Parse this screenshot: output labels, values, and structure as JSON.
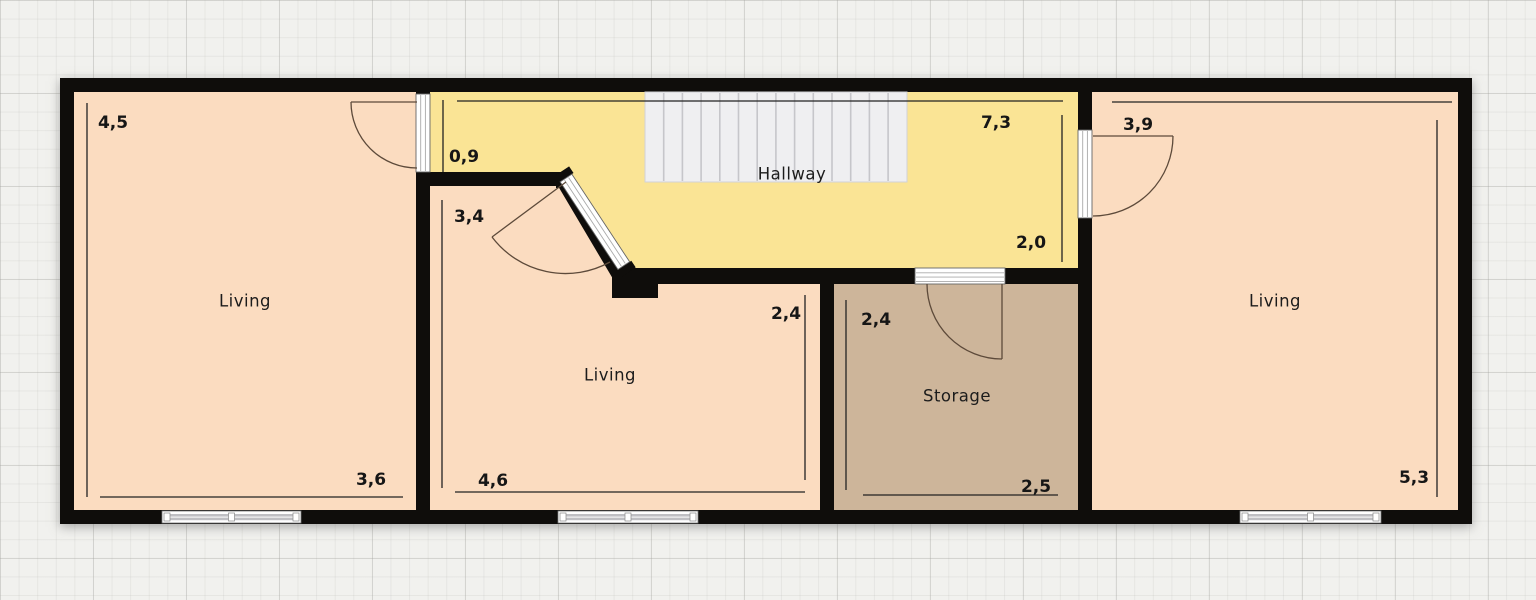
{
  "plan_type": "floorplan",
  "colors": {
    "wall": "#0f0d0b",
    "living_fill": "#fbdcc0",
    "hallway_fill": "#fae495",
    "storage_fill": "#cdb59a",
    "stairs_fill": "#efeff1",
    "grid_paper": "#f1f1ee",
    "dimension_line": "#222222",
    "door_arc": "#5d4a3a"
  },
  "rooms": {
    "living_left": {
      "label": "Living",
      "dim_height": "4,5",
      "dim_width": "3,6"
    },
    "living_middle": {
      "label": "Living",
      "dim_height_left": "3,4",
      "dim_height_right": "2,4",
      "dim_width": "4,6"
    },
    "hallway": {
      "label": "Hallway",
      "dim_width": "7,3",
      "dim_height_left": "0,9",
      "dim_height_right": "2,0"
    },
    "storage": {
      "label": "Storage",
      "dim_height": "2,4",
      "dim_width": "2,5"
    },
    "living_right": {
      "label": "Living",
      "dim_width": "3,9",
      "dim_height": "5,3"
    }
  }
}
